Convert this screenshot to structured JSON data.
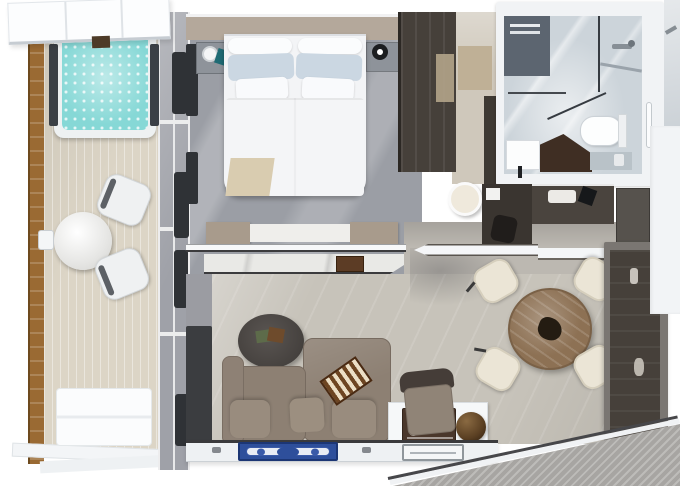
{
  "scene": {
    "view": "top-down-3d-rendered-floor-plan",
    "areas": {
      "balcony": {
        "items": [
          "canopy",
          "hot-tub",
          "wood-railing",
          "teak-deck",
          "round-table",
          "chair-upper",
          "chair-lower",
          "wall-sconce",
          "deck-mat",
          "glass-door-wall",
          "curtains"
        ]
      },
      "bedroom": {
        "items": [
          "double-bed",
          "bolsters",
          "blue-pillows",
          "white-pillows",
          "duvet",
          "beige-throw",
          "nightstand-left",
          "white-lamp",
          "teal-towel",
          "nightstand-right",
          "black-lamp",
          "wardrobe",
          "marble-console-partition",
          "wood-tray"
        ]
      },
      "entry": {
        "items": [
          "runner-mat",
          "closet-cabinet"
        ]
      },
      "bathroom": {
        "items": [
          "marble-floor",
          "dark-marble-wall",
          "towel-rack",
          "shower-glass-panels",
          "shower-head",
          "glass-shelf",
          "toilet",
          "toilet-tank",
          "towel-bar",
          "sink",
          "faucet",
          "dark-vanity-counter",
          "side-ledge",
          "tissue-box",
          "marble-strip",
          "door-handle"
        ]
      },
      "study-nook": {
        "items": [
          "round-pouf",
          "dark-desk",
          "paper",
          "desk-chair",
          "minibar-counter",
          "towel-tray",
          "black-kettle",
          "fridge-cabinet",
          "pointed-wall",
          "dining-top-wall"
        ]
      },
      "living-room": {
        "items": [
          "sectional-sofa",
          "seat-cushions",
          "backgammon-board",
          "oval-coffee-table",
          "green-book",
          "brown-book",
          "armchair",
          "white-console",
          "vintage-radio",
          "bronze-sphere",
          "window-column",
          "bottom-sill",
          "blue-ornate-rug",
          "serving-tray",
          "drawer-knobs"
        ]
      },
      "dining-area": {
        "items": [
          "round-wood-table",
          "dark-centerpiece",
          "chair-nw",
          "chair-ne",
          "chair-sw",
          "chair-se",
          "media-wall",
          "media-panel"
        ]
      },
      "exterior": {
        "items": [
          "ship-deck-corner",
          "deck-edge"
        ]
      }
    }
  },
  "colors": {
    "page_bg": "#ffffff",
    "deck": "#dcd5c6",
    "railing": "#9a6a33",
    "glass_wall": "#9fa1a8",
    "curtain": "#2f3236",
    "hot_tub_frame": "#eef1f2",
    "hot_tub_water": "#86d8d6",
    "tub_panel": "#3b4046",
    "canopy": "#fcfdfe",
    "balcony_chair": "#eff1f2",
    "balcony_mat": "#fbfcfd",
    "bedroom_floor": "#9b9ea5",
    "bedroom_wall": "#b4a89b",
    "nightstand": "#8e939a",
    "lamp_black": "#1c1e20",
    "towel_teal": "#1f6b74",
    "bed_linen": "#f3f4f6",
    "pillow_blue": "#cbd7e2",
    "throw_beige": "#d9ccb0",
    "wardrobe": "#46403a",
    "partition_cap": "#a89b8c",
    "partition_marble": "#e9e9e6",
    "wood_tray": "#5c3c25",
    "entry_floor": "#cfc8bb",
    "entry_mat": "#bfb096",
    "entry_cabinet": "#3e3933",
    "bath_wall": "#f1f3f5",
    "bath_floor": "#ccd4da",
    "bath_dark_wall": "#5c6570",
    "glass_line": "#363b41",
    "toilet": "#fdfefe",
    "sink": "#fcfdfd",
    "vanity_dark": "#3f2e23",
    "vanity_ledge": "#b9c2c8",
    "marble_strip": "#ccd2d7",
    "pouf": "#efe9dc",
    "desk": "#3a3530",
    "desk_chair": "#201d1b",
    "counter": "#4a443e",
    "fridge": "#56524d",
    "wall_white": "#f5f6f8",
    "dining_top_wall": "#f4f6f7",
    "living_floor": "#c7c3ba",
    "hall_floor": "#bcb8b1",
    "gray_wall": "#9b9ca2",
    "dark_column": "#3b3d40",
    "sofa": "#8d8073",
    "sofa_cushion": "#998c7e",
    "armchair_back": "#453d38",
    "armchair_seat": "#908477",
    "console_white": "#f6f8f9",
    "radio_brown": "#4a372b",
    "rug_blue": "#2e4f9b",
    "shelf_white": "#eef1f3",
    "tray_white": "#f4f6f7",
    "dining_table": "#8d7154",
    "dining_chair": "#ebe5d6",
    "centerpiece": "#241c12",
    "media_frame": "#7a7672",
    "media_panel": "#46403a",
    "right_wall": "#f2f4f6",
    "deck_corner": "#a7a5a2"
  }
}
